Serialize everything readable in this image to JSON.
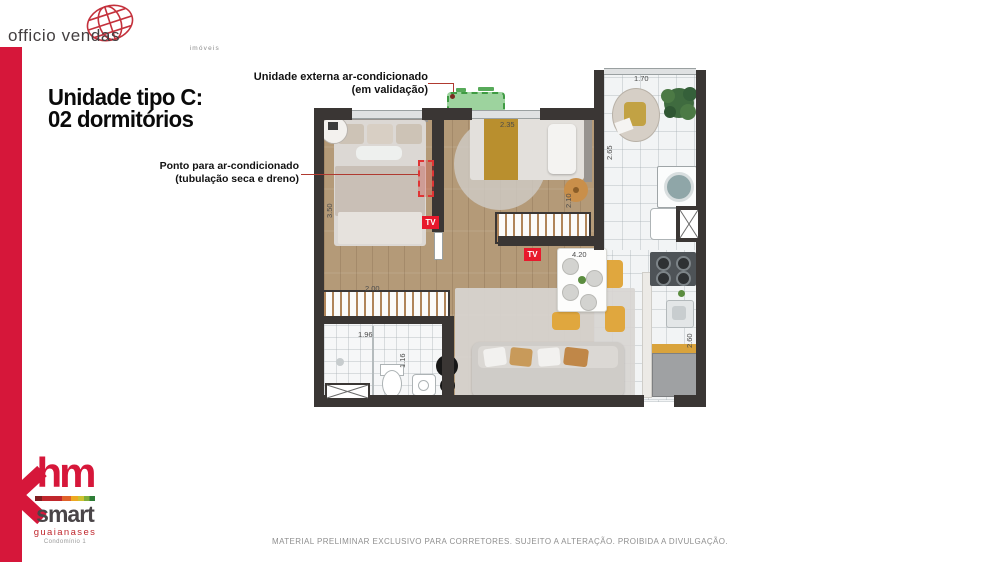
{
  "officio_logo": {
    "name": "officio vendas",
    "sub": "imóveis"
  },
  "title": {
    "line1": "Unidade tipo C:",
    "line2": "02 dormitórios"
  },
  "annotations": {
    "external_unit": {
      "line1": "Unidade externa ar-condicionado",
      "line2": "(em validação)"
    },
    "ac_point": {
      "line1": "Ponto para ar-condicionado",
      "line2": "(tubulação seca e dreno)"
    }
  },
  "plan": {
    "tv_label": "TV",
    "dimensions": {
      "balcony_width": "1.70",
      "balcony_depth": "2.65",
      "bedroom2_width": "2.35",
      "bedroom2_depth": "2.10",
      "bedroom1_depth": "3.50",
      "living_width": "4.20",
      "wardrobe_width": "2.00",
      "bathroom_width": "1.96",
      "bathroom_depth": "1.16",
      "kitchen_depth": "2.60"
    }
  },
  "hm_logo": {
    "hm": "hm",
    "smart": "smart",
    "neighborhood": "guaianases",
    "condo": "Condomínio 1"
  },
  "footer": {
    "disclaimer": "MATERIAL PRELIMINAR EXCLUSIVO PARA CORRETORES. SUJEITO A ALTERAÇÃO. PROIBIDA A DIVULGAÇÃO."
  },
  "colors": {
    "accent_red": "#d6173a",
    "leader_red": "#b03a30",
    "ac_green": "#3f9b43",
    "wall": "#3a3634",
    "tv_red": "#e8192c"
  }
}
